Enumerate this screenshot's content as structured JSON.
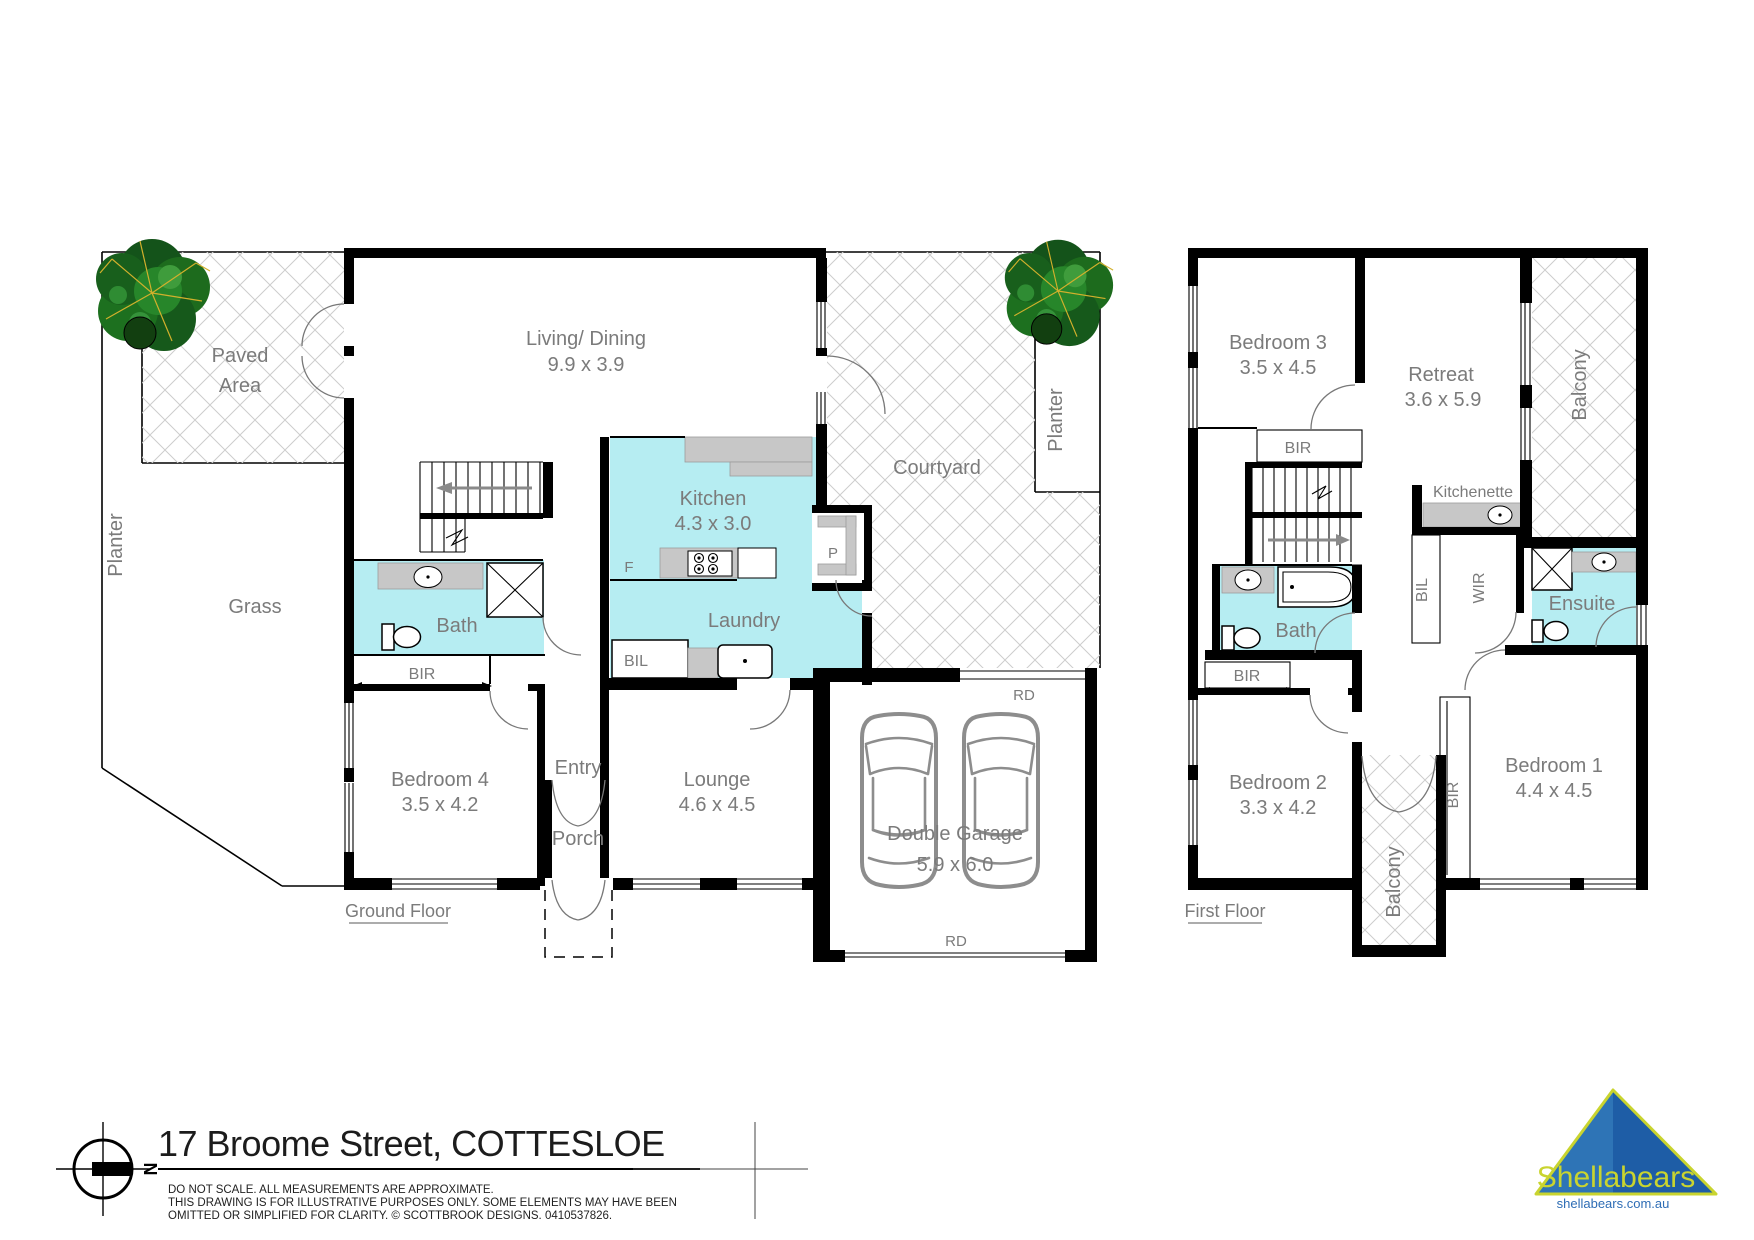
{
  "title_block": {
    "address": "17 Broome Street, COTTESLOE",
    "disclaimer_lines": [
      "DO NOT SCALE. ALL MEASUREMENTS ARE APPROXIMATE.",
      "THIS DRAWING IS FOR ILLUSTRATIVE PURPOSES ONLY. SOME ELEMENTS MAY HAVE BEEN",
      "OMITTED OR SIMPLIFIED FOR CLARITY. © SCOTTBROOK DESIGNS. 0410537826."
    ],
    "compass_letter": "N"
  },
  "branding": {
    "name": "Shellabears",
    "website": "shellabears.com.au"
  },
  "colors": {
    "room_fill": "#b6edf2",
    "fixture_grey": "#c7c7c7",
    "hatch_line": "#cdcdcd",
    "label_grey": "#7b7b7b",
    "wall": "#000000",
    "logo_blue": "#1e5da6",
    "logo_blue_light": "#2e74b6",
    "logo_yellow": "#c9d42f",
    "tree_green": "#1d6b1d"
  },
  "ground_floor": {
    "floor_label": "Ground Floor",
    "rooms": {
      "living_dining": {
        "name": "Living/ Dining",
        "dims": "9.9 x 3.9"
      },
      "kitchen": {
        "name": "Kitchen",
        "dims": "4.3 x 3.0"
      },
      "laundry": {
        "name": "Laundry"
      },
      "bath": {
        "name": "Bath"
      },
      "bedroom4": {
        "name": "Bedroom 4",
        "dims": "3.5 x 4.2"
      },
      "entry": {
        "name": "Entry"
      },
      "porch": {
        "name": "Porch"
      },
      "lounge": {
        "name": "Lounge",
        "dims": "4.6 x 4.5"
      },
      "double_garage": {
        "name": "Double Garage",
        "dims": "5.9 x 6.0"
      },
      "courtyard": {
        "name": "Courtyard"
      }
    },
    "outdoor": {
      "paved_area_line1": "Paved",
      "paved_area_line2": "Area",
      "grass": "Grass",
      "planter_left": "Planter",
      "planter_right": "Planter"
    },
    "labels": {
      "bir": "BIR",
      "bil": "BIL",
      "fridge": "F",
      "pantry": "P",
      "roller_door_top": "RD",
      "roller_door_bottom": "RD"
    }
  },
  "first_floor": {
    "floor_label": "First Floor",
    "rooms": {
      "bedroom3": {
        "name": "Bedroom 3",
        "dims": "3.5 x 4.5"
      },
      "retreat": {
        "name": "Retreat",
        "dims": "3.6 x 5.9"
      },
      "bedroom2": {
        "name": "Bedroom 2",
        "dims": "3.3 x 4.2"
      },
      "bedroom1": {
        "name": "Bedroom 1",
        "dims": "4.4 x 4.5"
      },
      "bath": {
        "name": "Bath"
      },
      "ensuite": {
        "name": "Ensuite"
      },
      "kitchenette": {
        "name": "Kitchenette"
      },
      "wir": {
        "name": "WIR"
      }
    },
    "labels": {
      "bir_bedroom3": "BIR",
      "bir_hall": "BIR",
      "bir_bedroom1": "BIR",
      "bil": "BIL",
      "balcony_top": "Balcony",
      "balcony_mid": "Balcony"
    }
  }
}
